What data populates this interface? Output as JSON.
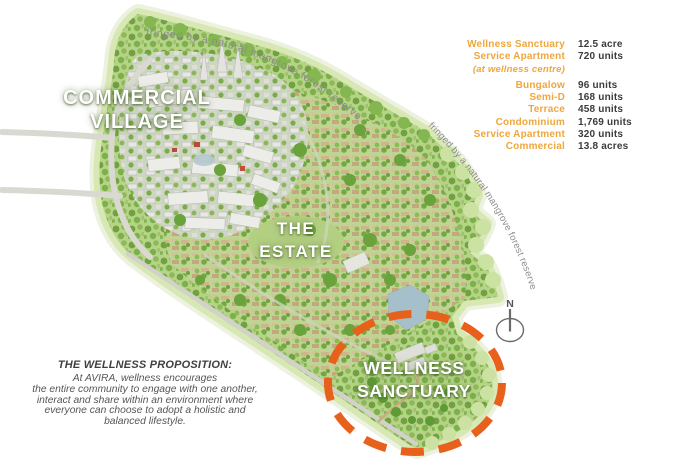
{
  "map": {
    "mangrove_note": "fringed by a natural mangrove forest reserve",
    "compass_letter": "N",
    "labels": {
      "commercial": [
        "COMMERCIAL",
        "VILLAGE"
      ],
      "estate": [
        "THE",
        "ESTATE"
      ],
      "sanctuary": [
        "WELLNESS",
        "SANCTUARY"
      ]
    },
    "colors": {
      "sanctuary_dash": "#e8611c",
      "land_green": "#b7d289",
      "fringe_green": "#d8e8b4",
      "water": "#a5c0ca",
      "road_gray": "#d9d9d2"
    }
  },
  "legend": {
    "label_color": "#f0a63c",
    "value_color": "#3b3b3b",
    "rows": [
      {
        "label": "Wellness Sanctuary",
        "value": "12.5 acre"
      },
      {
        "label": "Service Apartment",
        "value": "720 units"
      },
      {
        "label": "(at wellness centre)",
        "value": ""
      },
      {
        "label": "Bungalow",
        "value": "96 units"
      },
      {
        "label": "Semi-D",
        "value": "168 units"
      },
      {
        "label": "Terrace",
        "value": "458 units"
      },
      {
        "label": "Condominium",
        "value": "1,769 units"
      },
      {
        "label": "Service Apartment",
        "value": "320 units"
      },
      {
        "label": "Commercial",
        "value": "13.8 acres"
      }
    ]
  },
  "proposition": {
    "title": "THE WELLNESS PROPOSITION:",
    "lines": [
      "At AVIRA, wellness encourages",
      "the entire community to engage with one another,",
      "interact and share within an environment where",
      "everyone can choose to adopt a holistic and",
      "balanced lifestyle."
    ]
  }
}
